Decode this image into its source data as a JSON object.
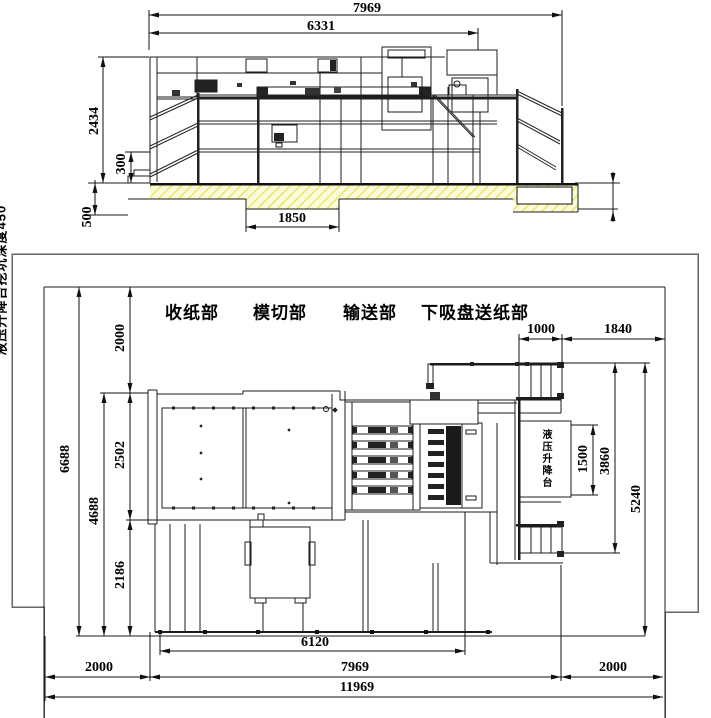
{
  "elevation": {
    "dim_total_length": "7969",
    "dim_body_length": "6331",
    "dim_height": "2434",
    "dim_base_height": "300",
    "dim_foundation_depth": "500",
    "dim_pit_width": "1850",
    "pit_depth_note": "液压升降台挖坑深度450"
  },
  "plan": {
    "sections": [
      "收纸部",
      "模切部",
      "输送部",
      "下吸盘送纸部"
    ],
    "lift_platform_label": "液压升降台",
    "dim_wall_offset_top": "2000",
    "dim_total_width": "6688",
    "dim_machine_width": "4688",
    "dim_upper_width": "2502",
    "dim_lower_width": "2186",
    "dim_stair_width": "1000",
    "dim_side_clearance": "1840",
    "dim_lift_length": "1500",
    "dim_lift_zone": "3860",
    "dim_right_zone": "5240",
    "dim_base_length": "6120",
    "dim_left_clearance": "2000",
    "dim_machine_length": "7969",
    "dim_right_clearance": "2000",
    "dim_total_length": "11969"
  }
}
